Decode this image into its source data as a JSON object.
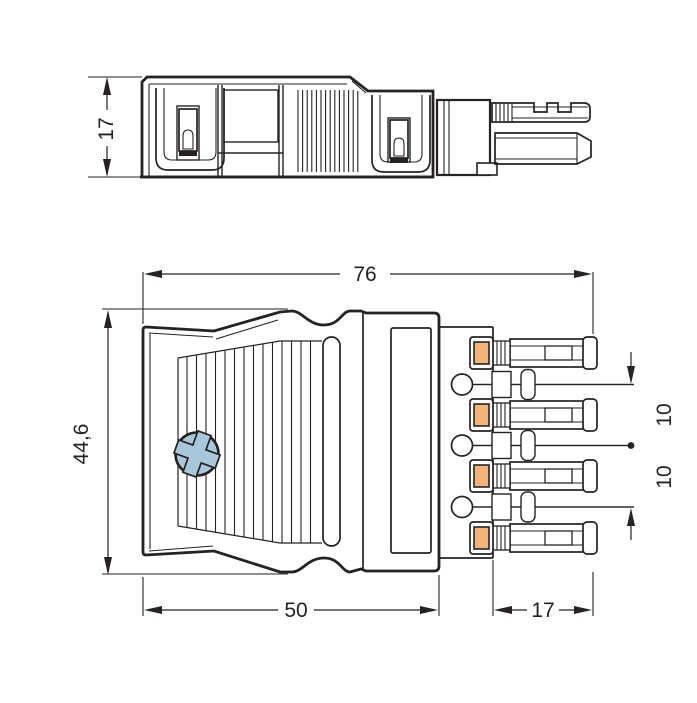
{
  "drawing": {
    "title": "plug-connector-dimension-drawing",
    "product": "5-pole plug connector with strain relief housing",
    "background_color": "#ffffff",
    "line_color": "#262223",
    "accent_colors": {
      "terminal_orange": "#f2b278",
      "screw_blue": "#a9c7da"
    },
    "side_view": {
      "dim_height": "17"
    },
    "front_view": {
      "dim_total_width": "76",
      "dim_height": "44,6",
      "dim_housing_width": "50",
      "dim_terminal_length": "17",
      "dim_pole_pitch_upper": "10",
      "dim_pole_pitch_lower": "10"
    }
  }
}
